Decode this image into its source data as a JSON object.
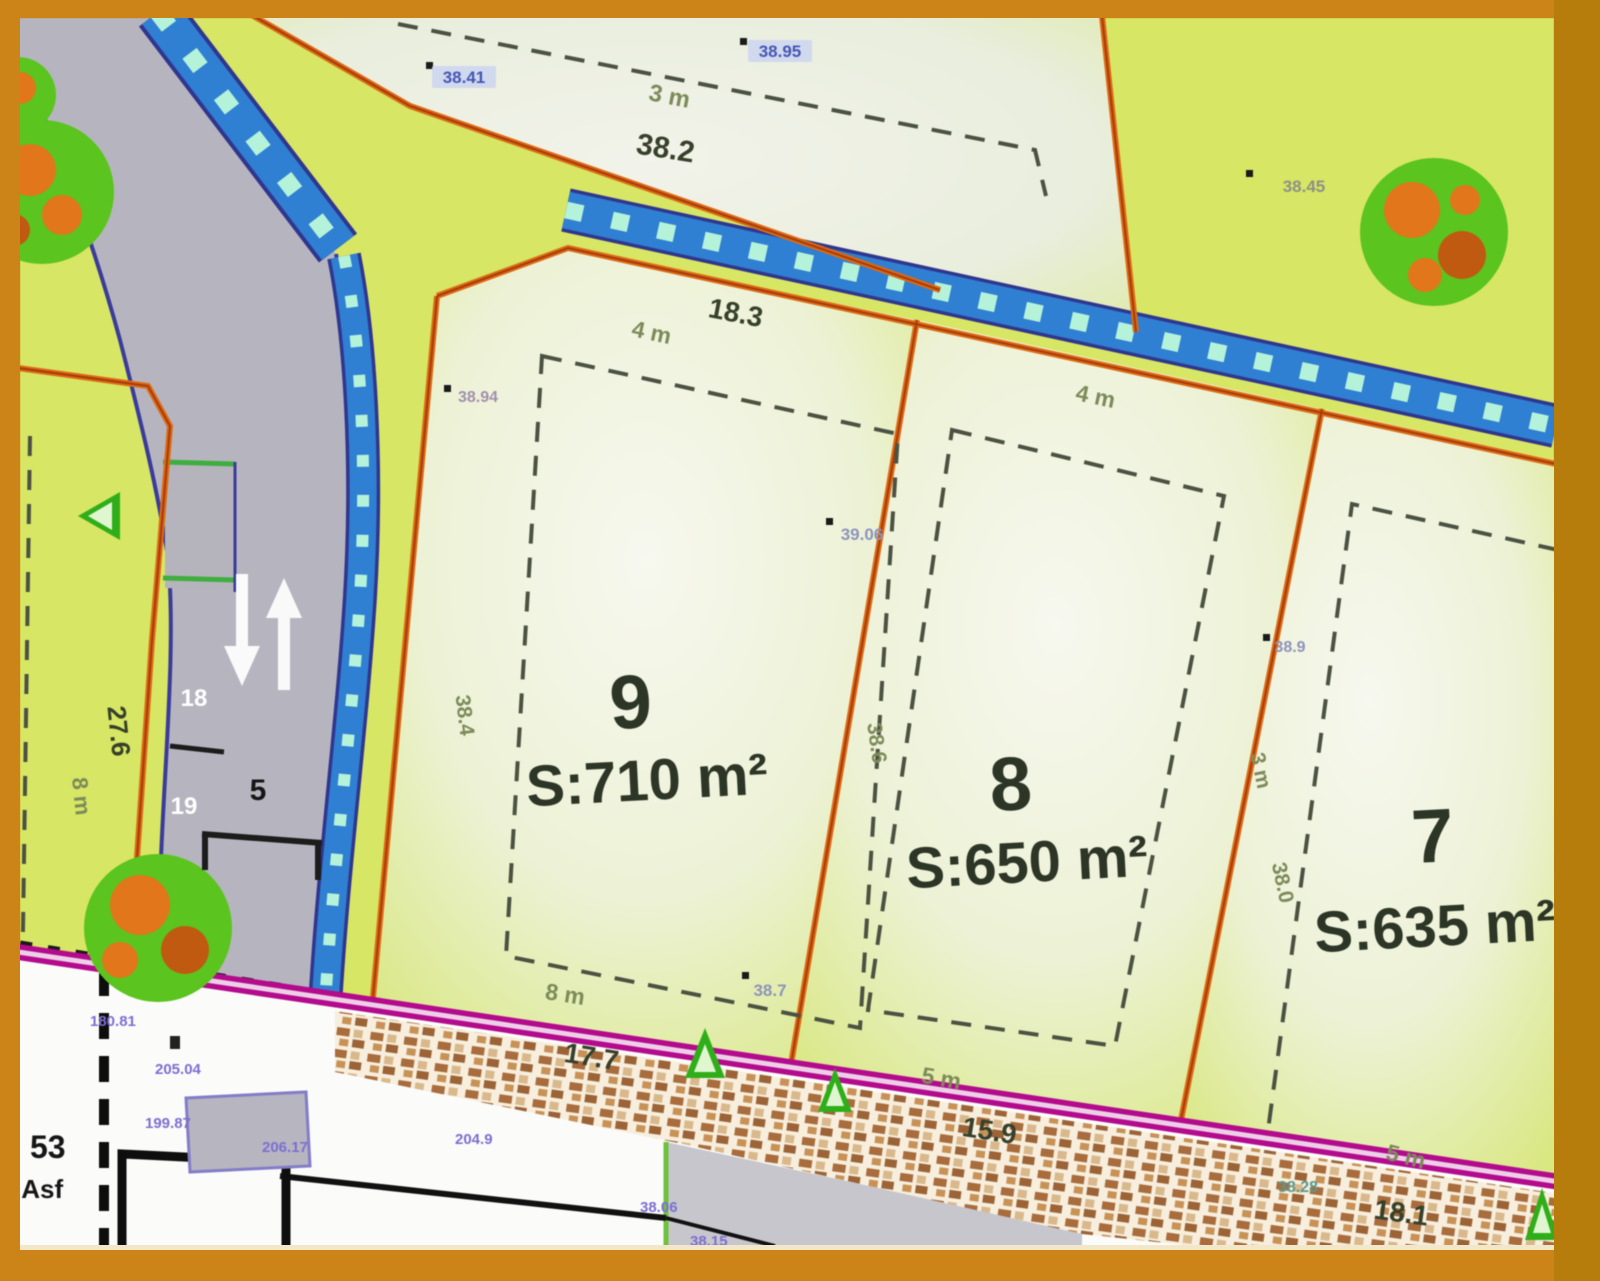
{
  "plan": {
    "plots": [
      {
        "number": "9",
        "area": "S:710 m²"
      },
      {
        "number": "8",
        "area": "S:650 m²"
      },
      {
        "number": "7",
        "area": "S:635 m²"
      }
    ],
    "top_plot": {
      "frontage": "38.2",
      "setback_depth": "3 m",
      "spot_a": "38.41",
      "spot_b": "38.95"
    },
    "dims": {
      "lot9_front_width": "18.3",
      "lot9_front_setback": "4 m",
      "lot8_front_setback": "4 m",
      "lot9_rear_width": "17.7",
      "lot9_rear_setback": "8 m",
      "lot8_rear_width": "15.9",
      "lot8_rear_setback": "5 m",
      "lot7_rear_width": "18.1",
      "lot7_rear_setback": "5 m",
      "lot9_side_length": "38.4",
      "lot8_side_length": "38.6",
      "lot7_side_length": "38.0",
      "lot7_side_setback": "3 m",
      "left_lot_depth": "27.6",
      "left_lot_setback": "8 m",
      "road_width": "5",
      "road_station_upper": "18",
      "road_station_lower": "19"
    },
    "spots": {
      "s1": "38.45",
      "s2": "38.94",
      "s3": "39.06",
      "s4": "38.9",
      "s5": "38.7",
      "s6": "38.28"
    },
    "survey": {
      "m1": "180.81",
      "m2": "205.04",
      "m3": "199.87",
      "m4": "206.17",
      "m5": "204.9",
      "m6": "38.06",
      "m7": "38.15"
    },
    "notes": {
      "block": "53",
      "surface": ".Asf",
      "partial": "Pro"
    }
  }
}
